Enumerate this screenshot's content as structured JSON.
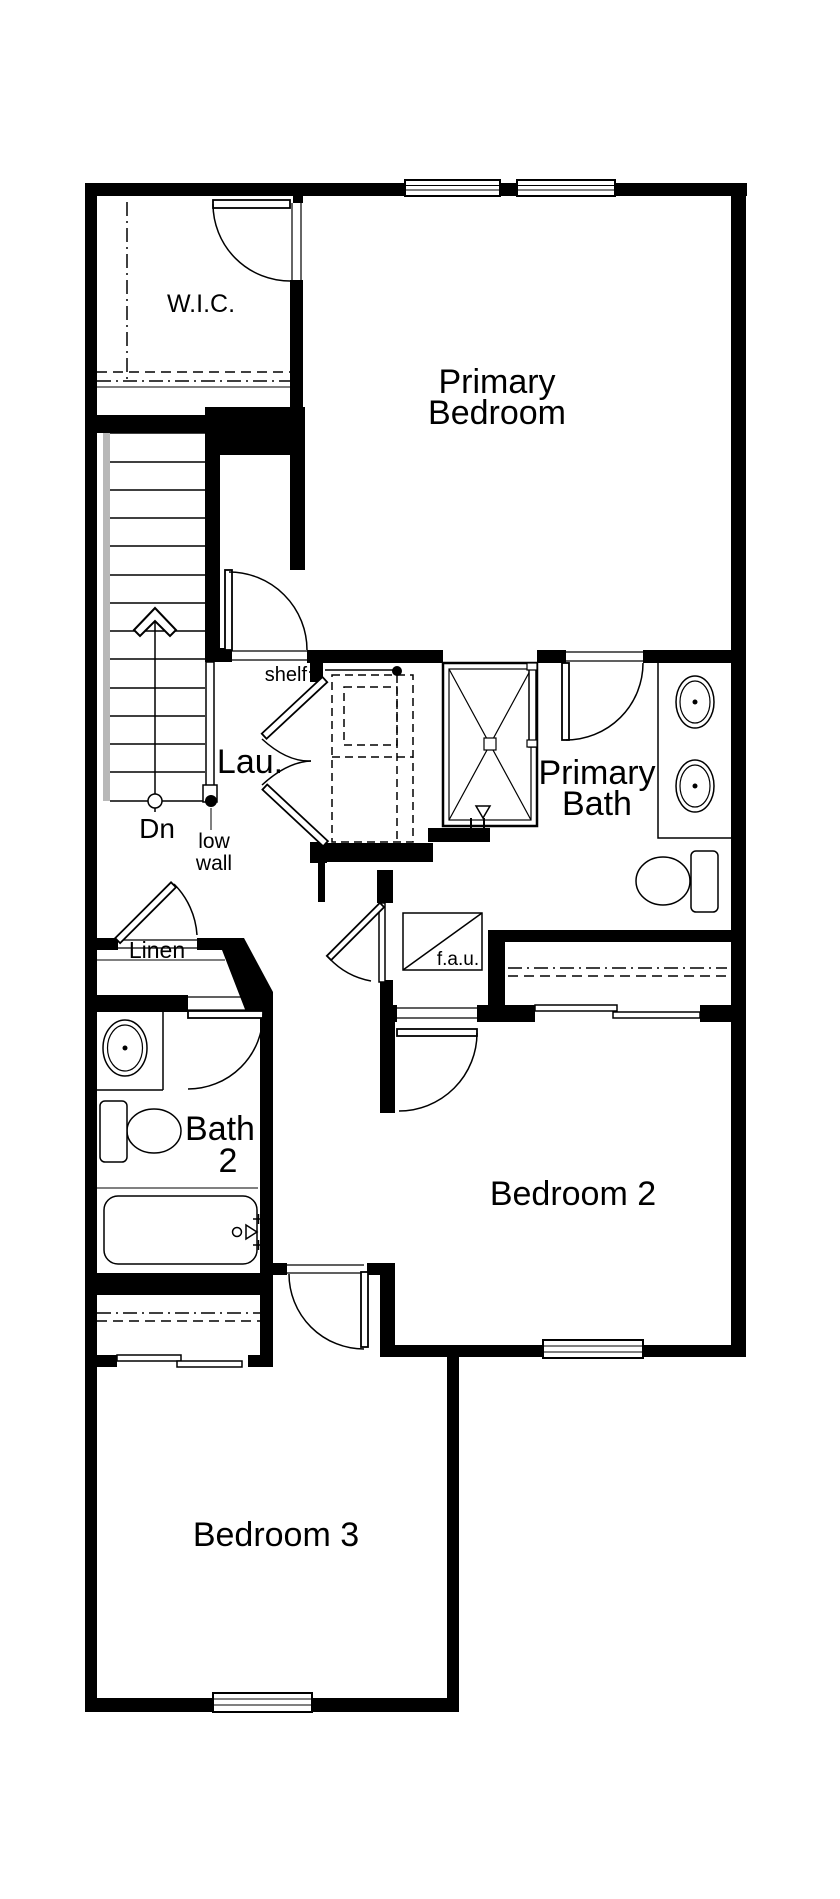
{
  "colors": {
    "wall": "#000000",
    "background": "#ffffff",
    "stair_edge": "#b8b8b8"
  },
  "labels": {
    "wic": "W.I.C.",
    "primary_bedroom_line1": "Primary",
    "primary_bedroom_line2": "Bedroom",
    "shelf": "shelf",
    "laundry": "Lau.",
    "down": "Dn",
    "low_wall_line1": "low",
    "low_wall_line2": "wall",
    "primary_bath_line1": "Primary",
    "primary_bath_line2": "Bath",
    "linen": "Linen",
    "fau": "f.a.u.",
    "bath2_line1": "Bath",
    "bath2_line2": "2",
    "bedroom2": "Bedroom 2",
    "bedroom3": "Bedroom 3"
  },
  "rooms": [
    {
      "name": "W.I.C."
    },
    {
      "name": "Primary Bedroom"
    },
    {
      "name": "Lau."
    },
    {
      "name": "Primary Bath"
    },
    {
      "name": "Linen"
    },
    {
      "name": "Bath 2"
    },
    {
      "name": "Bedroom 2"
    },
    {
      "name": "Bedroom 3"
    }
  ],
  "fixtures": [
    "stairs-down",
    "low-wall",
    "shelf-line",
    "washer-dryer-dashed",
    "fau-unit",
    "shower",
    "double-vanity-sinks",
    "toilet-primary-bath",
    "vanity-sink-bath2",
    "toilet-bath2",
    "bathtub",
    "window-top-left",
    "window-top-right",
    "window-bedroom2",
    "window-bedroom3",
    "wic-door",
    "bedroom-entry-door",
    "primary-bath-door",
    "laundry-bifold-doors",
    "linen-door",
    "fau-door",
    "bath2-door",
    "bedroom2-door",
    "bedroom3-door",
    "closet-sliding-doors-bedroom2",
    "closet-sliding-doors-bedroom3"
  ]
}
